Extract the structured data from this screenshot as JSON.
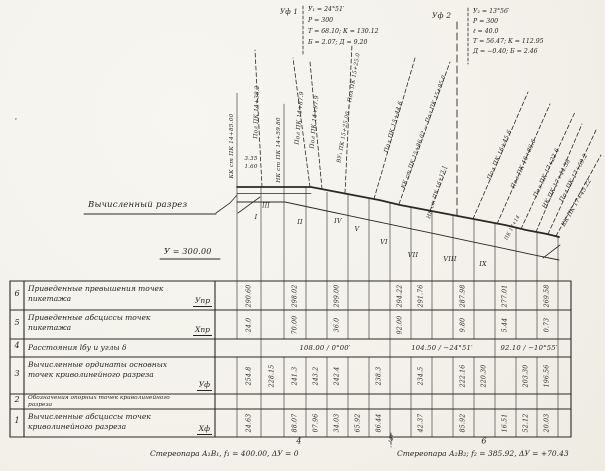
{
  "drawing": {
    "section_label": "Вычисленный разрез",
    "datum_label": "У = 300.00",
    "curve1": {
      "label": "Уф 1",
      "lines": [
        "У₁ = 24°51′",
        "Р = 300",
        "Т = 68.10;  К = 130.12",
        "Б = 2.07;  Д = 9.20"
      ]
    },
    "curve2": {
      "label": "Уф 2",
      "lines": [
        "У₂ = 13°56′",
        "Р = 300",
        "ℓ = 40.0",
        "Т = 56.47;  К = 112.95",
        "Д = −0.40;  Б = 2.46"
      ]
    },
    "annotations": [
      {
        "name": "curve-end-label",
        "t": "КК ст ПК 14+85.00",
        "x": 232,
        "y": 146,
        "r": -90,
        "fs": 5.8
      },
      {
        "name": "pol-line-label",
        "t": "Пол ПК 14+38.2",
        "x": 257,
        "y": 112,
        "r": -88,
        "fs": 5.8
      },
      {
        "name": "curve-start-label",
        "t": "НК ст ПК 14+59.80",
        "x": 279,
        "y": 150,
        "r": -90,
        "fs": 5.8
      },
      {
        "name": "pol-line-label",
        "t": "Пол ПК 14+87.9",
        "x": 300,
        "y": 118,
        "r": -85,
        "fs": 5.8
      },
      {
        "name": "pol-line-label",
        "t": "Пол ПК 14+97.9",
        "x": 315,
        "y": 122,
        "r": -85,
        "fs": 5.8
      },
      {
        "name": "vertex-line-label",
        "t": "ВУ₁ ПК 15+25.00 — Пол ПК 15+25.0",
        "x": 349,
        "y": 108,
        "r": -80,
        "fs": 5.4
      },
      {
        "name": "pol-line-label",
        "t": "Пол ПК 15+44.6",
        "x": 394,
        "y": 127,
        "r": -74,
        "fs": 5.8
      },
      {
        "name": "curve-end-label",
        "t": "КК ст ПК 15+86.02 — Пол ПК 15+95.0",
        "x": 424,
        "y": 132,
        "r": -70,
        "fs": 5.4
      },
      {
        "name": "curve-start-label",
        "t": "НК ст ПК 16+13.1",
        "x": 437,
        "y": 192,
        "r": -73,
        "fs": 5.2
      },
      {
        "name": "pol-line-label",
        "t": "Пол ПК 16+45.6",
        "x": 500,
        "y": 155,
        "r": -67,
        "fs": 5.8
      },
      {
        "name": "pol-line-label",
        "t": "Пол ПК 16+86.6",
        "x": 524,
        "y": 164,
        "r": -66,
        "fs": 5.8
      },
      {
        "name": "pol-line-label",
        "t": "Пол ПК 17+22.6",
        "x": 547,
        "y": 173,
        "r": -65,
        "fs": 5.8
      },
      {
        "name": "curve-start-label",
        "t": "НК ПК 17+44.38",
        "x": 557,
        "y": 184,
        "r": -63,
        "fs": 5.8
      },
      {
        "name": "pol-line-label",
        "t": "Пол ПК 17+59.2",
        "x": 574,
        "y": 178,
        "r": -62,
        "fs": 5.8
      },
      {
        "name": "curve-end-label",
        "t": "КК ПК 17+45.22",
        "x": 577,
        "y": 203,
        "r": -60,
        "fs": 5.8
      },
      {
        "name": "offset-value",
        "t": "3.35",
        "x": 251,
        "y": 159,
        "r": 0,
        "fs": 5.5
      },
      {
        "name": "offset-value",
        "t": "1.60",
        "x": 251,
        "y": 167,
        "r": 0,
        "fs": 5.5
      },
      {
        "name": "picket-label",
        "t": "ПК 17+14",
        "x": 513,
        "y": 228,
        "r": -62,
        "fs": 4.8
      },
      {
        "name": "point-I",
        "t": "I",
        "x": 256,
        "y": 217,
        "r": 0,
        "fs": 6.5
      },
      {
        "name": "point-II",
        "t": "II",
        "x": 300,
        "y": 222,
        "r": 0,
        "fs": 6.5
      },
      {
        "name": "point-III",
        "t": "III",
        "x": 266,
        "y": 206,
        "r": 0,
        "fs": 6
      },
      {
        "name": "point-IV",
        "t": "IV",
        "x": 338,
        "y": 221,
        "r": 0,
        "fs": 6.5
      },
      {
        "name": "point-V",
        "t": "V",
        "x": 357,
        "y": 229,
        "r": 0,
        "fs": 6.5
      },
      {
        "name": "point-VI",
        "t": "VI",
        "x": 384,
        "y": 242,
        "r": 0,
        "fs": 6.5
      },
      {
        "name": "point-VII",
        "t": "VII",
        "x": 413,
        "y": 255,
        "r": 0,
        "fs": 6.5
      },
      {
        "name": "point-VIII",
        "t": "VIII",
        "x": 450,
        "y": 259,
        "r": 0,
        "fs": 6.5
      },
      {
        "name": "point-IX",
        "t": "IX",
        "x": 483,
        "y": 264,
        "r": 0,
        "fs": 6.5
      },
      {
        "name": "scan-speck",
        "t": "·",
        "x": 16,
        "y": 120,
        "r": 0,
        "fs": 9
      }
    ],
    "bottom_ticks": [
      {
        "t": "4",
        "x": 299,
        "y": 441
      },
      {
        "t": "5",
        "x": 391,
        "y": 439
      },
      {
        "t": "6",
        "x": 484,
        "y": 441
      }
    ]
  },
  "table": {
    "rows": [
      {
        "num": "6",
        "label": "Приведенные превышения точек пикетажа",
        "symbol": "Упр",
        "values": [
          {
            "x": 249,
            "v": "290.60"
          },
          {
            "x": 295,
            "v": "298.02"
          },
          {
            "x": 337,
            "v": "299.00"
          },
          {
            "x": 400,
            "v": "294.22"
          },
          {
            "x": 421,
            "v": "291.76"
          },
          {
            "x": 463,
            "v": "287.98"
          },
          {
            "x": 505,
            "v": "277.01"
          },
          {
            "x": 547,
            "v": "269.58"
          }
        ]
      },
      {
        "num": "5",
        "label": "Приведенные абсциссы точек пикетажа",
        "symbol": "Хпр",
        "values": [
          {
            "x": 249,
            "v": "24.0"
          },
          {
            "x": 295,
            "v": "70.00"
          },
          {
            "x": 337,
            "v": "36.0"
          },
          {
            "x": 400,
            "v": "92.00"
          },
          {
            "x": 463,
            "v": "9.80"
          },
          {
            "x": 505,
            "v": "5.44"
          },
          {
            "x": 547,
            "v": "0.73"
          }
        ]
      },
      {
        "num": "4",
        "label": "Расстояния lбу и углы δ",
        "symbol": "",
        "segments": [
          {
            "x": 325,
            "v": "108.00 / 0°00′"
          },
          {
            "x": 442,
            "v": "104.50 / −24°51′"
          },
          {
            "x": 529,
            "v": "92.10 / −10°55′"
          }
        ]
      },
      {
        "num": "3",
        "label": "Вычисленные ординаты основных точек криволинейного разреза",
        "symbol": "Уф",
        "values": [
          {
            "x": 249,
            "v": "254.8"
          },
          {
            "x": 272,
            "v": "228.15"
          },
          {
            "x": 295,
            "v": "241.3"
          },
          {
            "x": 316,
            "v": "243.2"
          },
          {
            "x": 337,
            "v": "242.4"
          },
          {
            "x": 379,
            "v": "238.3"
          },
          {
            "x": 421,
            "v": "234.5"
          },
          {
            "x": 463,
            "v": "222.16"
          },
          {
            "x": 484,
            "v": "220.30"
          },
          {
            "x": 526,
            "v": "203.30"
          },
          {
            "x": 547,
            "v": "196.56"
          }
        ]
      },
      {
        "num": "2",
        "label": "Обозначения опорных точек криволинейного разреза",
        "symbol": "",
        "values": []
      },
      {
        "num": "1",
        "label": "Вычисленные абсциссы точек криволинейного разреза",
        "symbol": "Хф",
        "values": [
          {
            "x": 249,
            "v": "24.63"
          },
          {
            "x": 295,
            "v": "88.07"
          },
          {
            "x": 316,
            "v": "07.96"
          },
          {
            "x": 337,
            "v": "34.03"
          },
          {
            "x": 358,
            "v": "65.92"
          },
          {
            "x": 379,
            "v": "86.44"
          },
          {
            "x": 421,
            "v": "42.37"
          },
          {
            "x": 463,
            "v": "85.92"
          },
          {
            "x": 505,
            "v": "16.51"
          },
          {
            "x": 526,
            "v": "52.12"
          },
          {
            "x": 547,
            "v": "20.03"
          }
        ]
      }
    ],
    "footer_left": "Стереопара А₁В₁,  f₁ = 400.00,  ΔУ = 0",
    "footer_right": "Стереопара А₂В₂;  f₂ = 385.92,  ΔУ = +70.43"
  }
}
